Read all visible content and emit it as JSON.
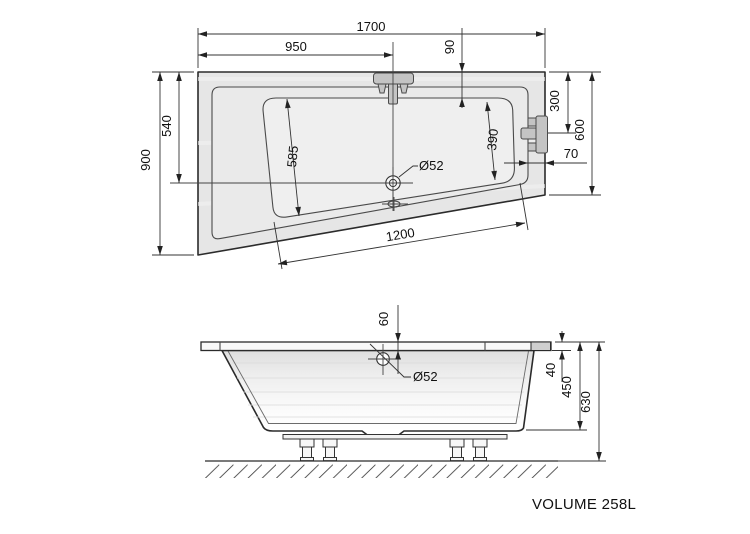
{
  "top_view": {
    "width": "1700",
    "faucet_offset": "950",
    "rim_front": "90",
    "depth_left": "900",
    "drain_offset": "540",
    "seat_left": "585",
    "seat_right": "390",
    "drain_dia": "Ø52",
    "overflow_offset": "300",
    "depth_right": "600",
    "rim_side": "70",
    "bottom_length": "1200"
  },
  "side_view": {
    "overflow_inset": "60",
    "overflow_dia": "Ø52",
    "rim_thickness": "40",
    "shell_height": "450",
    "total_height": "630"
  },
  "volume_label": "VOLUME 258L"
}
